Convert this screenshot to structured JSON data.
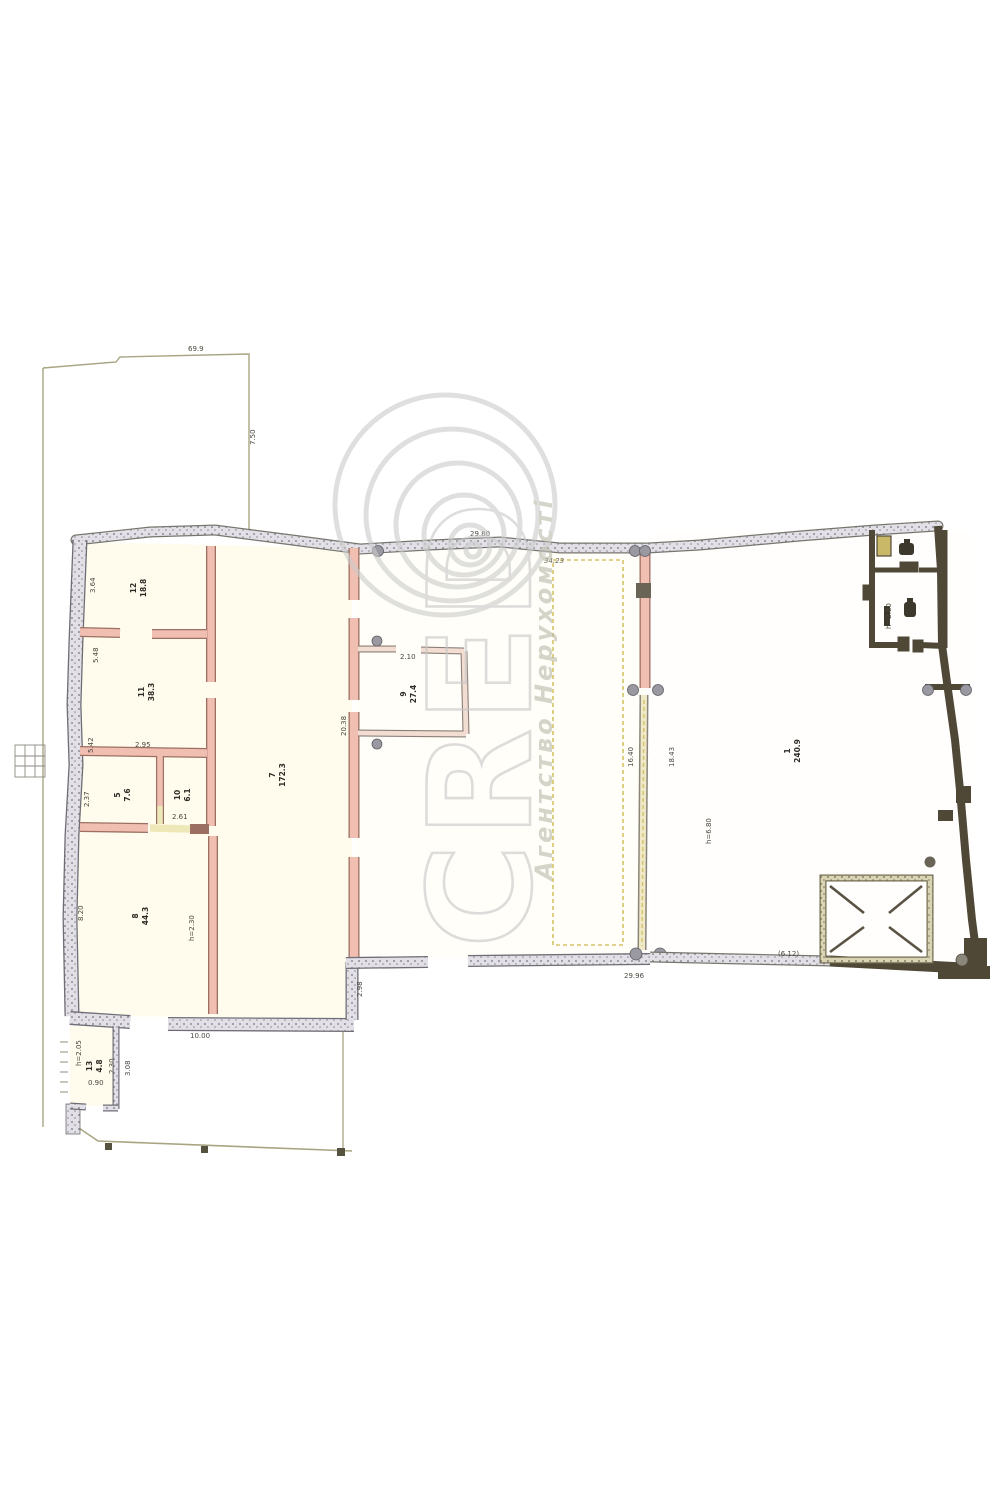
{
  "watermark": {
    "letters": "CRED",
    "agency": "Агентство Нерухомості"
  },
  "rooms": {
    "r12": {
      "num": "12",
      "area": "18.8"
    },
    "r11": {
      "num": "11",
      "area": "38.3"
    },
    "r5": {
      "num": "5",
      "area": "7.6"
    },
    "r10": {
      "num": "10",
      "area": "6.1"
    },
    "r7": {
      "num": "7",
      "area": "172.3"
    },
    "r8": {
      "num": "8",
      "area": "44.3"
    },
    "r9": {
      "num": "9",
      "area": "27.4"
    },
    "r13": {
      "num": "13",
      "area": "4.8"
    },
    "hall": {
      "num": "1",
      "area": "240.9"
    }
  },
  "dims": {
    "parcel_top": "69.9",
    "parcel_right": "7.50",
    "top_w1": "29.80",
    "top_w2": "34.23",
    "left_1": "3.64",
    "left_2": "5.48",
    "left_3": "5.42",
    "left_4": "2.37",
    "left_5": "8.20",
    "bottom_left": "10.00",
    "step_right": "2.98",
    "r7_len": "20.38",
    "wall_a": "2.95",
    "wall_b": "2.61",
    "r8_h": "h=2.30",
    "r13_h": "h=2.05",
    "r13_w": "2.30",
    "r13_l": "3.08",
    "r13_door": "0.90",
    "r9_door": "2.10",
    "annex_w": "16.40",
    "hall_w": "18.43",
    "hall_bottom": "29.96",
    "hall_h": "h=6.80",
    "platform": "(6.12)",
    "wc_h": "h=2.80"
  },
  "colors": {
    "paper": "#ffffff",
    "room_fill": "#fffdf0",
    "wall_pink": "#f1beb2",
    "wall_gray": "#e2e0e6",
    "wall_dark": "#4f4837",
    "dashed_line": "#d6c268",
    "watermark": "#c7c7c7"
  }
}
